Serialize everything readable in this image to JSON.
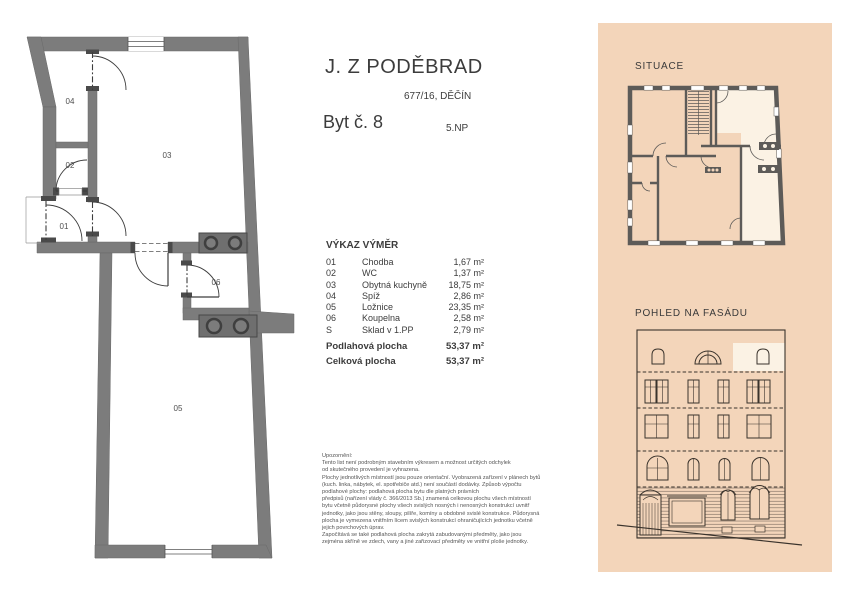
{
  "document": {
    "title": "J. Z PODĚBRAD",
    "address": "677/16, DĚČÍN",
    "unit": "Byt č. 8",
    "floor": "5.NP"
  },
  "area_table": {
    "title": "VÝKAZ VÝMĚR",
    "rows": [
      {
        "code": "01",
        "name": "Chodba",
        "area": "1,67 m²"
      },
      {
        "code": "02",
        "name": "WC",
        "area": "1,37 m²"
      },
      {
        "code": "03",
        "name": "Obytná kuchyně",
        "area": "18,75 m²"
      },
      {
        "code": "04",
        "name": "Spíž",
        "area": "2,86 m²"
      },
      {
        "code": "05",
        "name": "Ložnice",
        "area": "23,35 m²"
      },
      {
        "code": "06",
        "name": "Koupelna",
        "area": "2,58 m²"
      },
      {
        "code": "S",
        "name": "Sklad v 1.PP",
        "area": "2,79 m²"
      }
    ],
    "totals": [
      {
        "label": "Podlahová plocha",
        "area": "53,37 m²"
      },
      {
        "label": "Celková plocha",
        "area": "53,37 m²"
      }
    ]
  },
  "floor_plan": {
    "labels": {
      "chodba": "01",
      "wc": "02",
      "kuchyne": "03",
      "spiz": "04",
      "loznice": "05",
      "koupelna": "06"
    }
  },
  "side_panel": {
    "situace_title": "SITUACE",
    "facade_title": "POHLED NA FASÁDU"
  },
  "notes": {
    "heading": "Upozornění:",
    "lines": [
      "Tento list není podrobným stavebním výkresem a možnost určitých odchylek",
      "od skutečného provedení je vyhrazena.",
      "Plochy jednotlivých místností jsou pouze orientační. Vyobrazená zařízení v plánech bytů",
      "(kuch. linka, nábytek, el. spotřebiče atd.) není součástí dodávky. Způsob výpočtu",
      "podlahové plochy: podlahová plocha bytu dle platných právních",
      "předpisů (nařízení vlády č. 366/2013 Sb.) znamená celkovou plochu všech místností",
      "bytu včetně půdorysné plochy všech svislých nosných i nenosných konstrukcí uvnitř",
      "jednotky, jako jsou stěny, sloupy, pilíře, komíny a obdobné svislé konstrukce. Půdorysná",
      "plocha je vymezena vnitřním lícem svislých konstrukcí ohraničujících jednotku včetně",
      "jejich povrchových úprav.",
      "Započítává se také podlahová plocha zakrytá zabudovanými předměty, jako jsou",
      "zejména skříně ve zdech, vany a jiné zařizovací předměty ve vnitřní ploše jednotky."
    ]
  },
  "colors": {
    "panel_background": "#f3d5ba",
    "highlight_cream": "#fbf2e4",
    "wall_gray": "#7c7c7c",
    "ink": "#3c3c3c"
  }
}
